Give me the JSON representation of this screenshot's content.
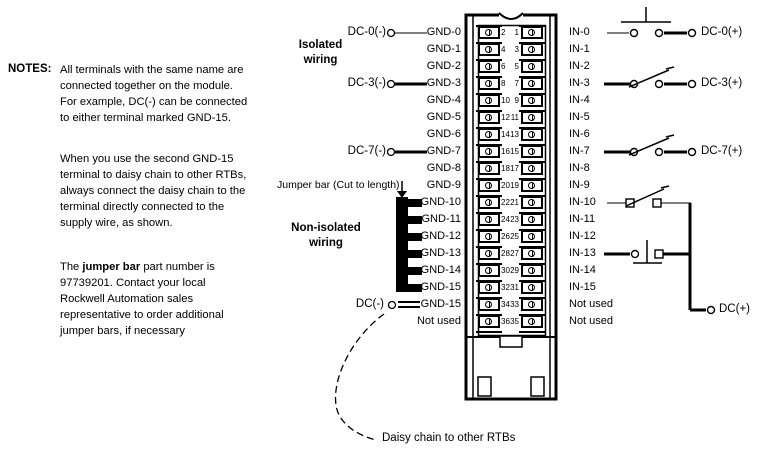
{
  "notes": {
    "label": "NOTES:",
    "p1": "All terminals with the same name are\nconnected together on the module.\nFor example, DC(-) can be connected\nto either terminal marked GND-15.",
    "p2": "When you use the second GND-15\nterminal to daisy chain to other RTBs,\nalways connect the daisy chain to the\nterminal directly connected to the\nsupply wire, as shown.",
    "p3_pre": "The ",
    "p3_bold": "jumper bar",
    "p3_post": " part number is\n97739201. Contact your local\nRockwell Automation sales\nrepresentative to order additional\njumper bars, if necessary"
  },
  "sections": {
    "isolated": "Isolated\nwiring",
    "non_isolated": "Non-isolated\nwiring",
    "jumper_bar_callout": "Jumper bar (Cut to length)",
    "daisy_chain": "Daisy chain to other RTBs"
  },
  "left_circuit": {
    "dc0_minus": "DC-0(-)",
    "dc3_minus": "DC-3(-)",
    "dc7_minus": "DC-7(-)",
    "dc_minus": "DC(-)"
  },
  "right_circuit": {
    "dc0_plus": "DC-0(+)",
    "dc3_plus": "DC-3(+)",
    "dc7_plus": "DC-7(+)",
    "dc_plus": "DC(+)"
  },
  "colors": {
    "line": "#000000",
    "background": "#ffffff"
  },
  "terminal_block": {
    "rows": [
      {
        "left": "GND-0",
        "even": "2",
        "odd": "1",
        "right": "IN-0"
      },
      {
        "left": "GND-1",
        "even": "4",
        "odd": "3",
        "right": "IN-1"
      },
      {
        "left": "GND-2",
        "even": "6",
        "odd": "5",
        "right": "IN-2"
      },
      {
        "left": "GND-3",
        "even": "8",
        "odd": "7",
        "right": "IN-3"
      },
      {
        "left": "GND-4",
        "even": "10",
        "odd": "9",
        "right": "IN-4"
      },
      {
        "left": "GND-5",
        "even": "12",
        "odd": "11",
        "right": "IN-5"
      },
      {
        "left": "GND-6",
        "even": "14",
        "odd": "13",
        "right": "IN-6"
      },
      {
        "left": "GND-7",
        "even": "16",
        "odd": "15",
        "right": "IN-7"
      },
      {
        "left": "GND-8",
        "even": "18",
        "odd": "17",
        "right": "IN-8"
      },
      {
        "left": "GND-9",
        "even": "20",
        "odd": "19",
        "right": "IN-9"
      },
      {
        "left": "GND-10",
        "even": "22",
        "odd": "21",
        "right": "IN-10"
      },
      {
        "left": "GND-11",
        "even": "24",
        "odd": "23",
        "right": "IN-11"
      },
      {
        "left": "GND-12",
        "even": "26",
        "odd": "25",
        "right": "IN-12"
      },
      {
        "left": "GND-13",
        "even": "28",
        "odd": "27",
        "right": "IN-13"
      },
      {
        "left": "GND-14",
        "even": "30",
        "odd": "29",
        "right": "IN-14"
      },
      {
        "left": "GND-15",
        "even": "32",
        "odd": "31",
        "right": "IN-15"
      },
      {
        "left": "GND-15",
        "even": "34",
        "odd": "33",
        "right": "Not used"
      },
      {
        "left": "Not used",
        "even": "36",
        "odd": "35",
        "right": "Not used"
      }
    ]
  }
}
